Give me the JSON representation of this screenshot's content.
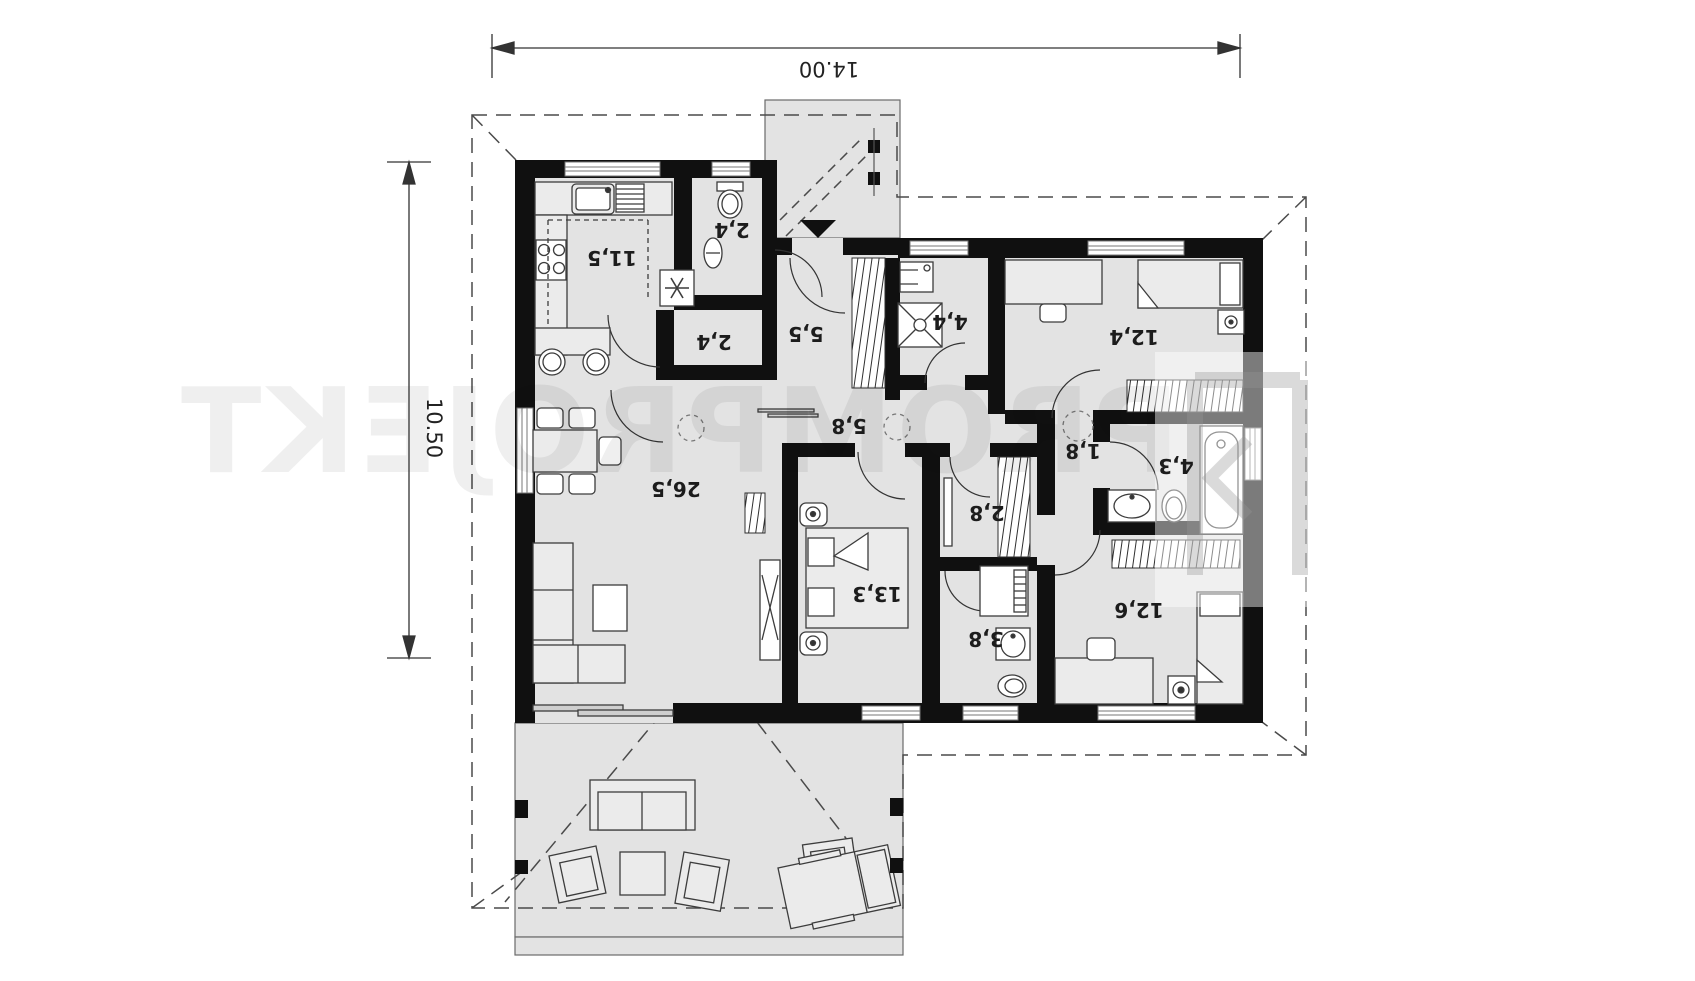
{
  "dimensions": {
    "top_width": "14.00",
    "left_height": "10.50"
  },
  "rooms": {
    "kitchen": "11,5",
    "wc": "2,4",
    "pantry": "2,4",
    "hall": "5,5",
    "utility": "4,4",
    "bedroom1": "12,4",
    "corridor": "5,8",
    "inner_hall": "1,8",
    "bathroom1": "4,3",
    "closet": "2,8",
    "bedroom2": "13,3",
    "bathroom2": "3,8",
    "bedroom3": "12,6",
    "living_room": "26,5"
  },
  "watermark": {
    "text": "PROMPROJEKT"
  },
  "colors": {
    "wall": "#101010",
    "floor": "#e3e3e3",
    "furniture": "#ebebeb",
    "line": "#3c3c3c",
    "dash": "#4a4a4a"
  }
}
